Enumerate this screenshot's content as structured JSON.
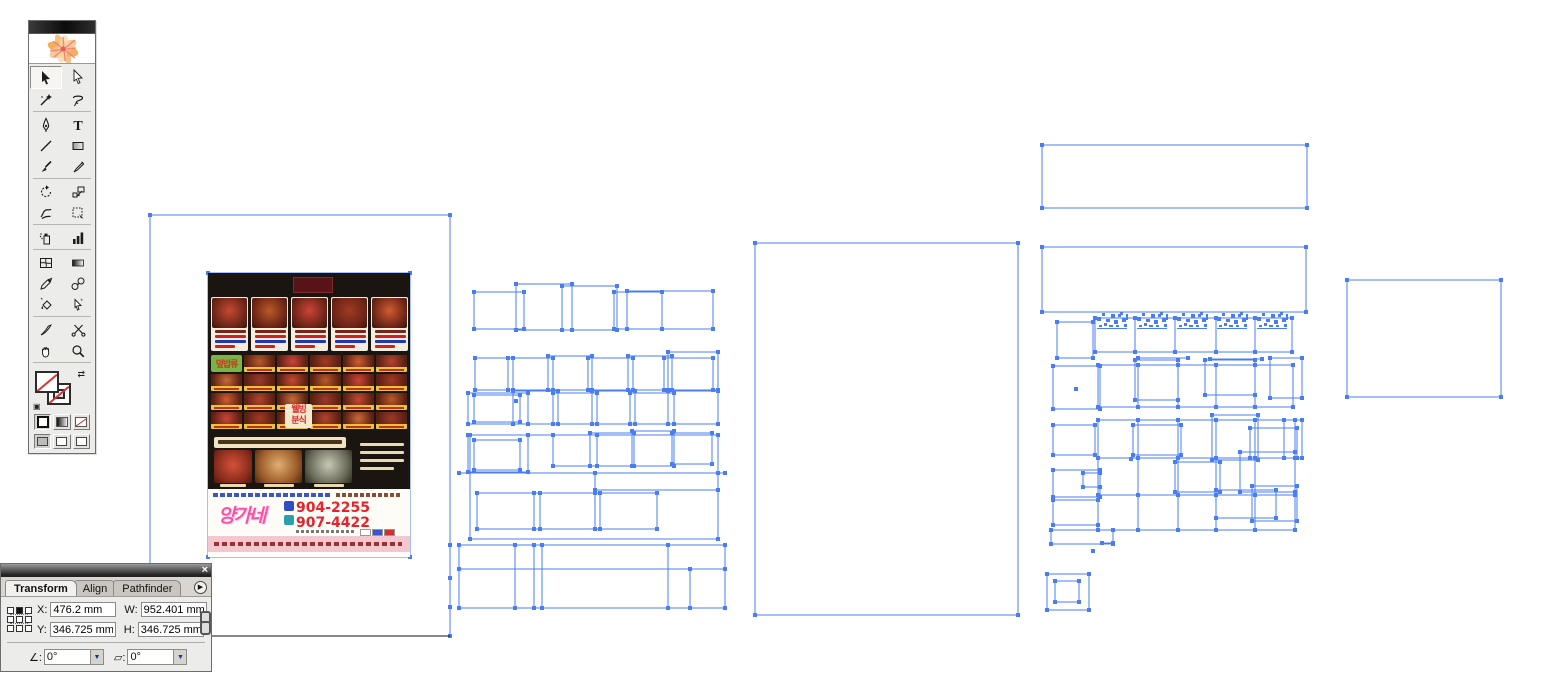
{
  "app": {
    "background": "#ffffff",
    "selection_color": "#4a7cf2"
  },
  "toolbar": {
    "tools": [
      {
        "name": "selection",
        "active": true
      },
      {
        "name": "direct-selection",
        "active": false
      },
      {
        "name": "magic-wand",
        "active": false
      },
      {
        "name": "lasso",
        "active": false
      },
      {
        "name": "pen",
        "active": false
      },
      {
        "name": "type",
        "active": false
      },
      {
        "name": "line-segment",
        "active": false
      },
      {
        "name": "rectangle",
        "active": false
      },
      {
        "name": "paintbrush",
        "active": false
      },
      {
        "name": "pencil",
        "active": false
      },
      {
        "name": "rotate",
        "active": false
      },
      {
        "name": "scale",
        "active": false
      },
      {
        "name": "warp",
        "active": false
      },
      {
        "name": "free-transform",
        "active": false
      },
      {
        "name": "symbol-sprayer",
        "active": false
      },
      {
        "name": "column-graph",
        "active": false
      },
      {
        "name": "mesh",
        "active": false
      },
      {
        "name": "gradient",
        "active": false
      },
      {
        "name": "eyedropper",
        "active": false
      },
      {
        "name": "blend",
        "active": false
      },
      {
        "name": "live-paint-bucket",
        "active": false
      },
      {
        "name": "live-paint-selection",
        "active": false
      },
      {
        "name": "knife",
        "active": false
      },
      {
        "name": "scissors",
        "active": false
      },
      {
        "name": "hand",
        "active": false
      },
      {
        "name": "zoom",
        "active": false
      }
    ]
  },
  "transform_panel": {
    "tabs": [
      "Transform",
      "Align",
      "Pathfinder"
    ],
    "x_label": "X:",
    "x_value": "476.2 mm",
    "y_label": "Y:",
    "y_value": "346.725 mm",
    "w_label": "W:",
    "w_value": "952.401 mm",
    "h_label": "H:",
    "h_value": "346.725 mm",
    "rotate_value": "0°",
    "shear_value": "0°",
    "close_glyph": "×",
    "menu_glyph": "▶",
    "dropdown_glyph": "▼"
  },
  "flyer": {
    "store_name": "양가네",
    "phone_1": "904-2255",
    "phone_2": "907-4422",
    "category_label": "덮밥류",
    "wellbeing_line_1": "웰빙",
    "wellbeing_line_2": "분식",
    "card_count": 5,
    "grid_rows": 4,
    "grid_cols": 6
  },
  "canvas": {
    "artboard": [
      150,
      215,
      300,
      421
    ],
    "black_lines": [
      [
        150,
        636,
        450,
        636
      ]
    ],
    "rects": [
      [
        150,
        215,
        300,
        421
      ],
      [
        208,
        273,
        202,
        284
      ],
      [
        755,
        243,
        263,
        372
      ],
      [
        1042,
        145,
        265,
        63
      ],
      [
        1042,
        247,
        264,
        65
      ],
      [
        1347,
        280,
        154,
        117
      ],
      [
        474,
        292,
        50,
        37
      ],
      [
        516,
        284,
        56,
        46
      ],
      [
        562,
        286,
        55,
        44
      ],
      [
        614,
        292,
        48,
        37
      ],
      [
        627,
        291,
        86,
        38
      ],
      [
        475,
        358,
        38,
        32
      ],
      [
        508,
        358,
        45,
        32
      ],
      [
        548,
        356,
        44,
        34
      ],
      [
        588,
        358,
        45,
        32
      ],
      [
        628,
        356,
        44,
        34
      ],
      [
        664,
        358,
        49,
        32
      ],
      [
        668,
        352,
        50,
        38
      ],
      [
        468,
        393,
        60,
        31
      ],
      [
        474,
        395,
        46,
        27
      ],
      [
        513,
        391,
        45,
        33
      ],
      [
        553,
        393,
        44,
        31
      ],
      [
        592,
        391,
        43,
        33
      ],
      [
        630,
        393,
        44,
        31
      ],
      [
        668,
        391,
        50,
        33
      ],
      [
        468,
        435,
        60,
        37
      ],
      [
        474,
        440,
        46,
        30
      ],
      [
        553,
        435,
        44,
        31
      ],
      [
        590,
        433,
        44,
        33
      ],
      [
        632,
        431,
        42,
        35
      ],
      [
        672,
        433,
        40,
        31
      ],
      [
        470,
        435,
        248,
        104
      ],
      [
        595,
        473,
        123,
        17
      ],
      [
        477,
        493,
        63,
        36
      ],
      [
        534,
        493,
        66,
        36
      ],
      [
        595,
        493,
        62,
        36
      ],
      [
        459,
        545,
        266,
        63
      ],
      [
        459,
        545,
        266,
        24
      ],
      [
        1057,
        322,
        36,
        36
      ],
      [
        1095,
        318,
        40,
        34
      ],
      [
        1135,
        318,
        40,
        34
      ],
      [
        1175,
        318,
        41,
        34
      ],
      [
        1216,
        318,
        39,
        34
      ],
      [
        1255,
        318,
        37,
        34
      ],
      [
        1053,
        366,
        47,
        43
      ],
      [
        1098,
        365,
        40,
        42
      ],
      [
        1138,
        365,
        40,
        42
      ],
      [
        1178,
        365,
        38,
        42
      ],
      [
        1216,
        365,
        39,
        42
      ],
      [
        1255,
        365,
        38,
        42
      ],
      [
        1270,
        358,
        32,
        40
      ],
      [
        1205,
        360,
        50,
        35
      ],
      [
        1135,
        360,
        43,
        40
      ],
      [
        1098,
        420,
        40,
        38
      ],
      [
        1138,
        420,
        40,
        38
      ],
      [
        1178,
        420,
        38,
        38
      ],
      [
        1216,
        420,
        39,
        38
      ],
      [
        1255,
        420,
        40,
        38
      ],
      [
        1133,
        425,
        48,
        30
      ],
      [
        1212,
        415,
        46,
        45
      ],
      [
        1250,
        428,
        47,
        30
      ],
      [
        1284,
        420,
        18,
        38
      ],
      [
        1098,
        458,
        40,
        37
      ],
      [
        1138,
        458,
        40,
        37
      ],
      [
        1178,
        458,
        38,
        37
      ],
      [
        1216,
        458,
        39,
        37
      ],
      [
        1255,
        458,
        40,
        37
      ],
      [
        1240,
        452,
        55,
        40
      ],
      [
        1175,
        462,
        45,
        30
      ],
      [
        1098,
        495,
        40,
        35
      ],
      [
        1138,
        495,
        40,
        35
      ],
      [
        1178,
        495,
        38,
        35
      ],
      [
        1216,
        495,
        39,
        35
      ],
      [
        1255,
        495,
        40,
        35
      ],
      [
        1216,
        490,
        60,
        28
      ],
      [
        1252,
        486,
        45,
        35
      ],
      [
        1053,
        425,
        42,
        30
      ],
      [
        1053,
        470,
        47,
        27
      ],
      [
        1083,
        473,
        17,
        14
      ],
      [
        1053,
        500,
        45,
        25
      ],
      [
        1051,
        530,
        62,
        14
      ],
      [
        1047,
        574,
        42,
        36
      ],
      [
        1055,
        581,
        24,
        21
      ]
    ],
    "lines": [
      [
        459,
        473,
        725,
        473
      ],
      [
        515,
        545,
        515,
        608
      ],
      [
        534,
        545,
        534,
        608
      ],
      [
        542,
        545,
        542,
        608
      ],
      [
        668,
        545,
        668,
        608
      ],
      [
        690,
        569,
        690,
        608
      ],
      [
        1138,
        358,
        1188,
        358
      ],
      [
        1210,
        359,
        1262,
        359
      ],
      [
        1102,
        543,
        1113,
        543
      ]
    ],
    "extra_anchors": [
      [
        690,
        569
      ],
      [
        313,
        427
      ],
      [
        450,
        545
      ],
      [
        450,
        578
      ],
      [
        450,
        607
      ],
      [
        516,
        401
      ],
      [
        1076,
        389
      ],
      [
        1131,
        459
      ],
      [
        1093,
        551
      ]
    ],
    "glyph_clusters": [
      [
        1097,
        312
      ],
      [
        1137,
        312
      ],
      [
        1177,
        312
      ],
      [
        1217,
        312
      ],
      [
        1257,
        312
      ]
    ]
  }
}
